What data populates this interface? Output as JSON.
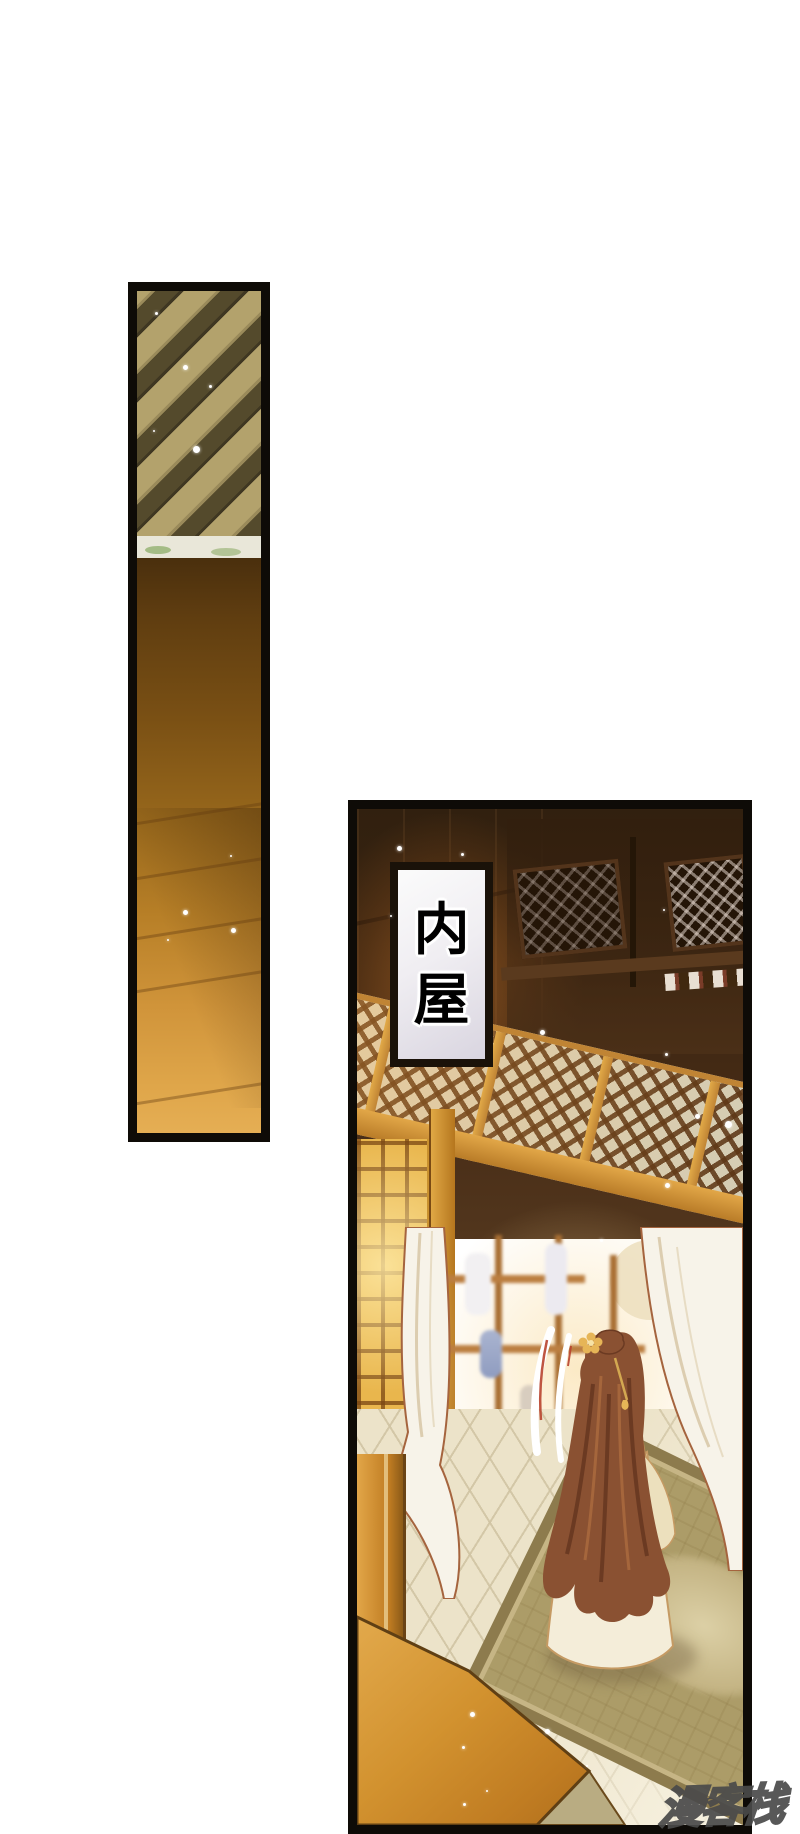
{
  "page": {
    "width_px": 800,
    "height_px": 1834,
    "background": "#ffffff"
  },
  "caption": {
    "text": "内屋",
    "chars": [
      "内",
      "屋"
    ]
  },
  "watermark": {
    "text": "漫客栈"
  },
  "palette": {
    "panel_border": "#0e0b07",
    "ceiling_tan": "#b3a26c",
    "ceiling_beam_dark": "#544a2c",
    "wall_brown_top": "#4a2f0d",
    "wall_gold_bottom": "#e5ae54",
    "room_ceiling_dark": "#31200f",
    "caption_frame": "#1a1209",
    "caption_fill": "#f0eef2",
    "glow_orange": "#c8762c",
    "lattice_frame_gold": "#d89b3e",
    "lattice_light": "#e7ead8",
    "window_gold": "#e9b64d",
    "curtain_white": "#f7f3e9",
    "curtain_outline": "#a5643e",
    "shelf_wood": "#bb7e40",
    "hair_auburn": "#8a5132",
    "robe_cream": "#f4edd9",
    "rug_olive": "#ac9c68",
    "floor_cream": "#ece3c9",
    "chest_orange": "#d2922f",
    "sparkle": "#ffffff",
    "watermark_fill": "#e0e0e0",
    "watermark_outline": "#4a4a4a"
  }
}
